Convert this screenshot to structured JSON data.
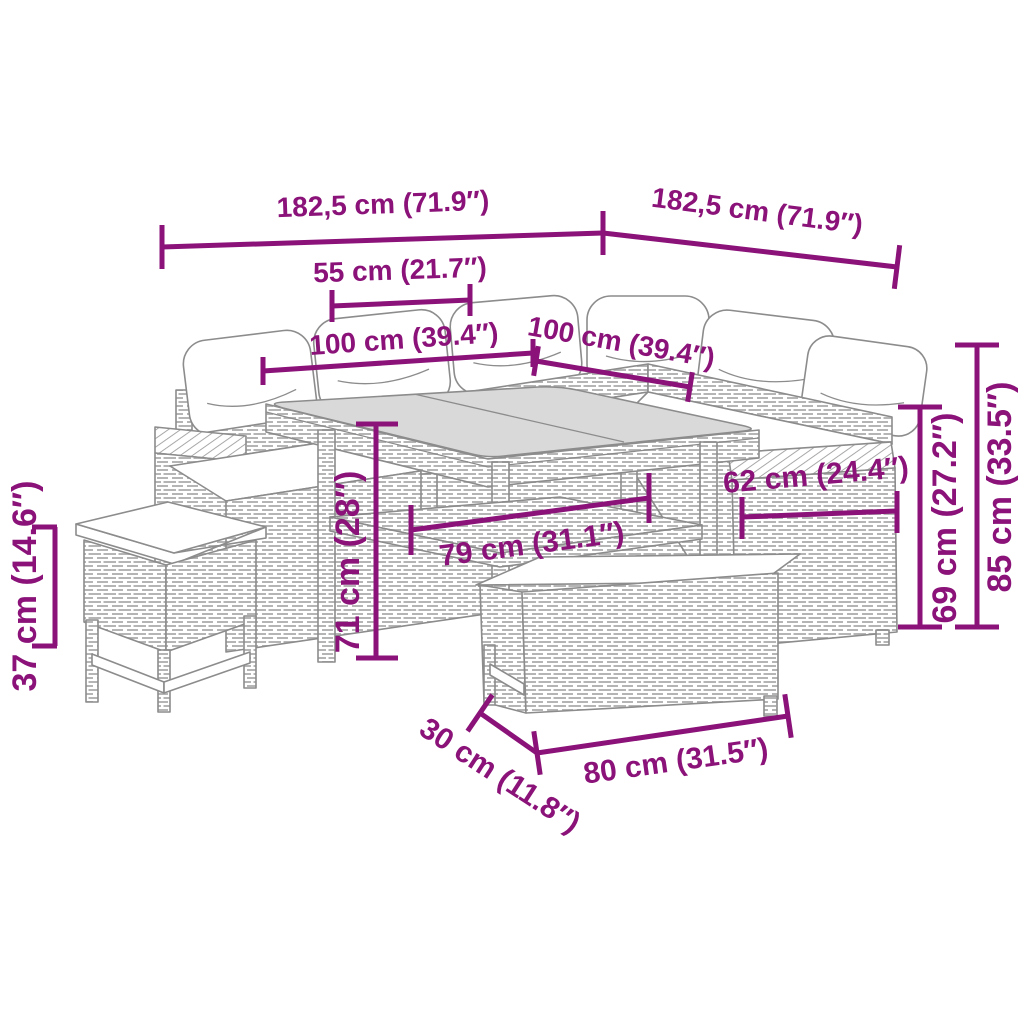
{
  "diagram": {
    "type": "product-dimension-diagram",
    "subject": "rattan-garden-furniture-set"
  },
  "colors": {
    "accent": "#8A1278",
    "ink": "#8c8c8c",
    "glass": "#d9d9d9",
    "paper": "#ffffff"
  },
  "dims": [
    {
      "id": "total-width-left",
      "label": "182,5 cm (71.9″)"
    },
    {
      "id": "total-width-right",
      "label": "182,5 cm (71.9″)"
    },
    {
      "id": "tabletop-half",
      "label": "55 cm (21.7″)"
    },
    {
      "id": "sofa-left-length",
      "label": "100 cm (39.4″)"
    },
    {
      "id": "sofa-right-length",
      "label": "100 cm (39.4″)"
    },
    {
      "id": "table-height",
      "label": "71 cm (28″)"
    },
    {
      "id": "table-width",
      "label": "79 cm (31.1″)"
    },
    {
      "id": "armrest-depth",
      "label": "62 cm (24.4″)"
    },
    {
      "id": "seat-back-height",
      "label": "69 cm (27.2″)"
    },
    {
      "id": "total-height",
      "label": "85 cm (33.5″)"
    },
    {
      "id": "stool-height",
      "label": "37 cm (14.6″)"
    },
    {
      "id": "bench-depth",
      "label": "30 cm (11.8″)"
    },
    {
      "id": "bench-length",
      "label": "80 cm (31.5″)"
    }
  ]
}
